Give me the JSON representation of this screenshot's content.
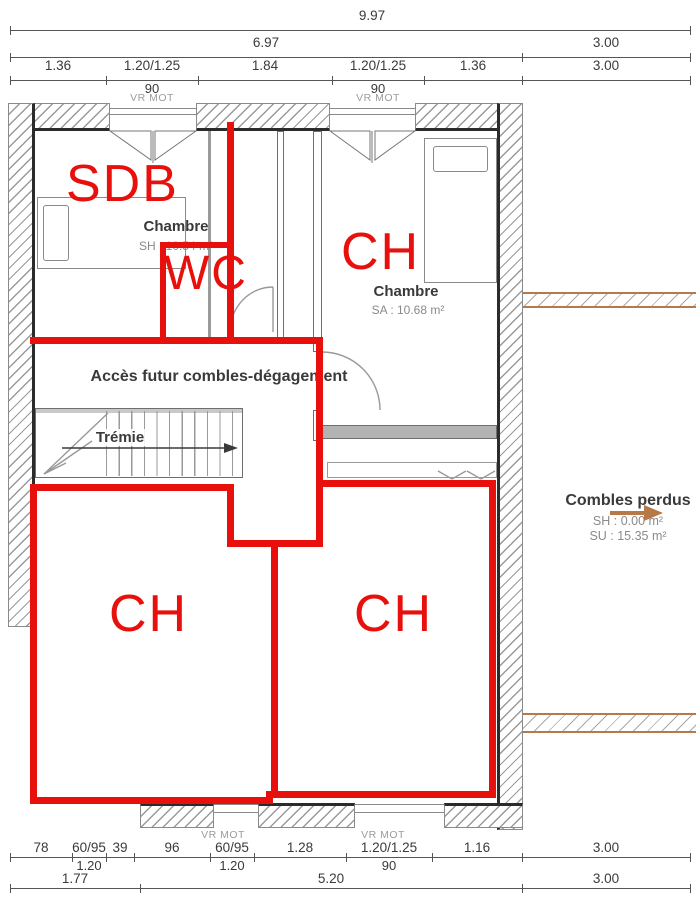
{
  "colors": {
    "red": "#e8100c",
    "tan": "#b5794a"
  },
  "dims_top": {
    "total": "9.97",
    "row2": [
      "6.97",
      "3.00"
    ],
    "row3": [
      "1.36",
      "1.20/1.25",
      "1.84",
      "1.20/1.25",
      "1.36",
      "3.00"
    ],
    "row3_sub": [
      "90",
      "90"
    ],
    "vr": [
      "VR MOT",
      "VR MOT"
    ]
  },
  "dims_bottom": {
    "row1": [
      "78",
      "60/95",
      "39",
      "96",
      "60/95",
      "1.28",
      "1.20/1.25",
      "1.16",
      "3.00"
    ],
    "row1_sub": [
      "1.20",
      "1.20",
      "90"
    ],
    "row2": [
      "1.77",
      "5.20",
      "3.00"
    ],
    "vr": [
      "VR MOT",
      "VR MOT"
    ]
  },
  "rooms": {
    "chambre_left": {
      "name": "Chambre",
      "area": "SH : 10.54 m²"
    },
    "chambre_right": {
      "name": "Chambre",
      "area": "SA : 10.68 m²"
    },
    "access": {
      "label": "Accès futur combles-dégagement"
    },
    "stair": {
      "label": "Trémie"
    },
    "combles": {
      "name": "Combles perdus",
      "sh": "SH : 0.00 m²",
      "su": "SU : 15.35 m²"
    }
  },
  "annotations": {
    "sdb": "SDB",
    "wc": "WC",
    "ch_right": "CH",
    "ch_bottom_left": "CH",
    "ch_bottom_right": "CH"
  }
}
